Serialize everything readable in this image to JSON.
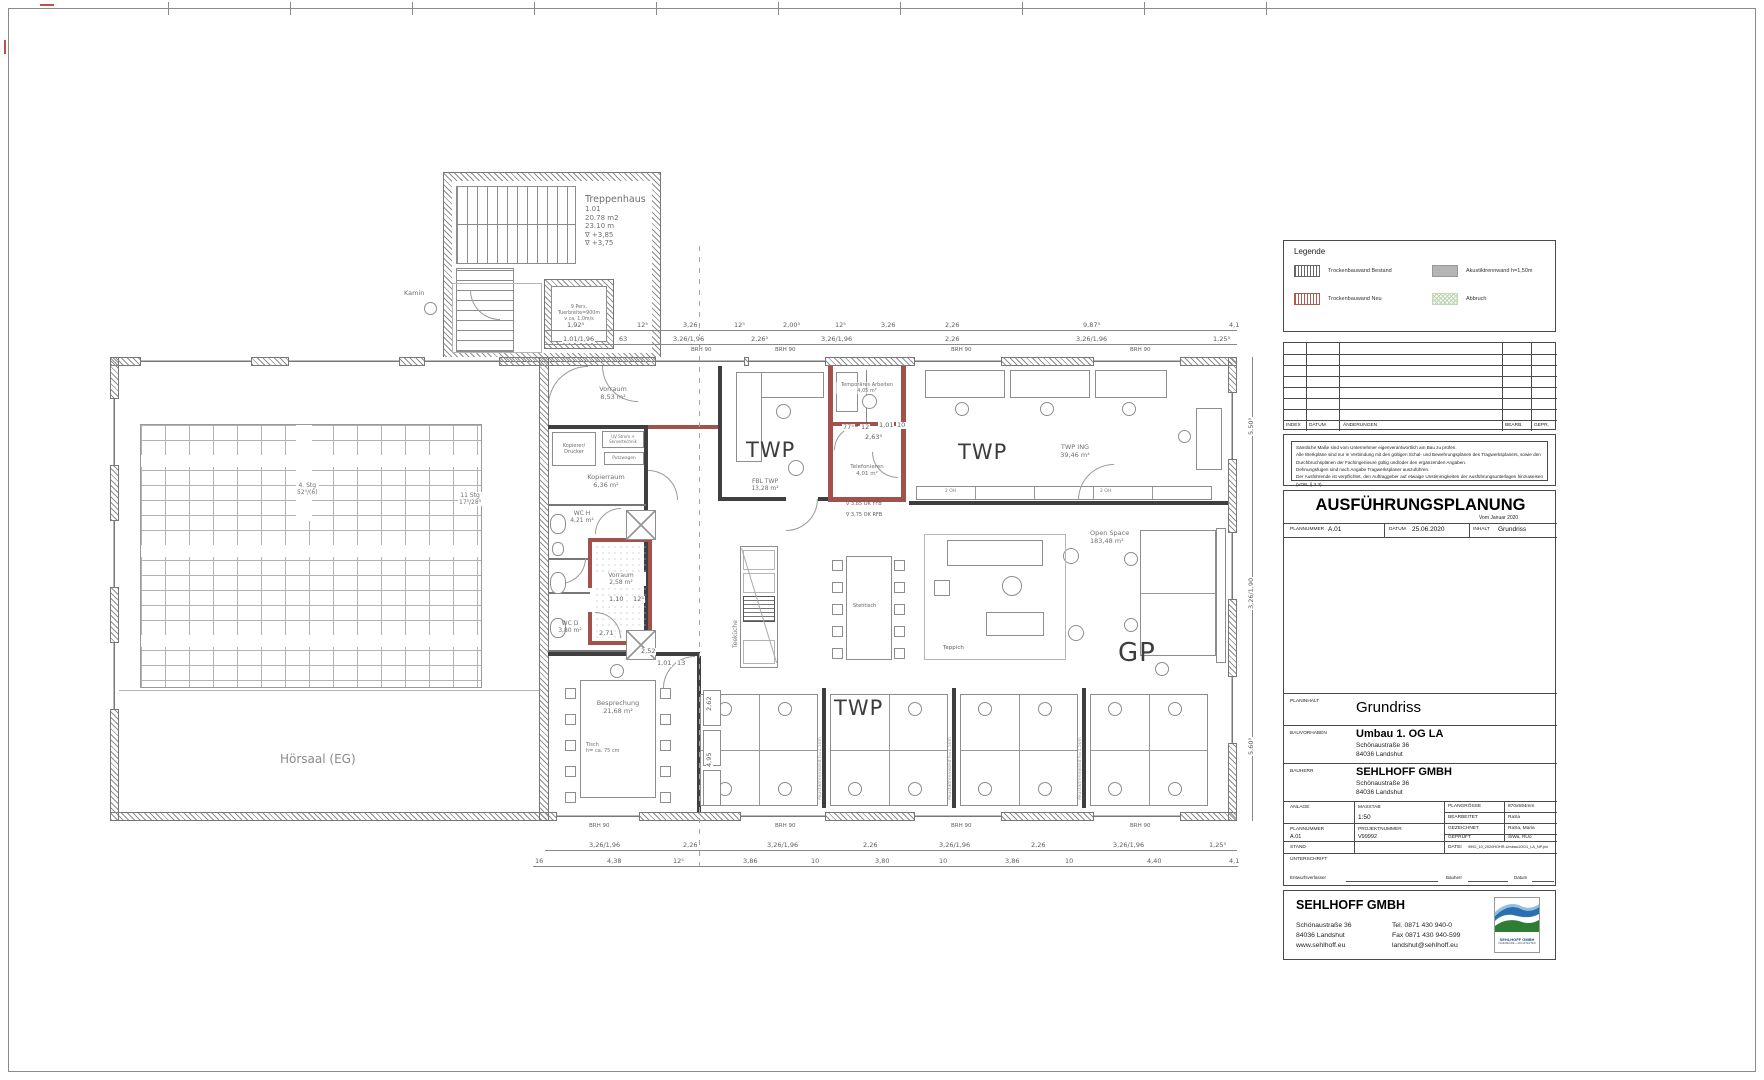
{
  "plan": {
    "treppenhaus": {
      "name": "Treppenhaus",
      "nr": "1.01",
      "area": "20.78 m2",
      "len": "23.10 m",
      "lv1": "∇  +3,85",
      "lv2": "∇  +3,75"
    },
    "aufzug": {
      "l1": "9 Pers.",
      "l2": "Tuerbreite=900m",
      "l3": "v ca. 1,0m/s"
    },
    "kamin": "Kamin",
    "hoersaal": "Hörsaal (EG)",
    "stair1": {
      "l1": "4. Stg",
      "l2": "52⁵/(6)"
    },
    "stair2": {
      "l1": "11 Stg",
      "l2": "17⁵/28⁵"
    },
    "brh": "BRH 90",
    "akustik": "Akustiktrennwand h=1,50m",
    "cabinet": "2 OH",
    "gp": "GP",
    "twp": "TWP"
  },
  "rooms": {
    "vorraum1": {
      "name": "Vorraum",
      "area": "8,53 m²"
    },
    "kopierer": {
      "l1": "Kopierer/",
      "l2": "Drucker"
    },
    "uv": {
      "l1": "UV Strom +",
      "l2": "Servertechnik"
    },
    "putzwagen": "Putzwagen",
    "kopierraum": {
      "name": "Kopierraum",
      "area": "6,36 m²"
    },
    "wch": {
      "name": "WC H",
      "area": "4,21 m²"
    },
    "vorraum2": {
      "name": "Vorraum",
      "area": "2,58 m²"
    },
    "wcd": {
      "name": "WC D",
      "area": "3,80 m²"
    },
    "besprechung": {
      "name": "Besprechung",
      "area": "21,68 m²",
      "note1": "Tisch",
      "note2": "h= ca. 75 cm"
    },
    "teekueche": "Teeküche",
    "stehtisch": "Stehtisch",
    "teppich": "Teppich",
    "fbl": {
      "name": "FBL TWP",
      "area": "13,28 m²"
    },
    "temp": {
      "name": "Temporäres Arbeiten",
      "area": "4,05 m²"
    },
    "telefonieren": {
      "name": "Telefonieren",
      "area": "4,01 m²"
    },
    "twping": {
      "name": "TWP ING",
      "area": "39,46 m²"
    },
    "openspace": {
      "name": "Open Space",
      "area": "183,48 m²"
    }
  },
  "dims": {
    "top1": [
      "1,92⁵",
      "12⁵",
      "3,26",
      "12⁵",
      "2,00⁵",
      "12⁵",
      "3,26",
      "2,26",
      "9,87⁵",
      "4,1"
    ],
    "top2": [
      "1,01/1,96",
      "63",
      "3,26/1,96",
      "2,26⁵",
      "3,26/1,96",
      "2,26",
      "3,26/1,96",
      "1,25⁵"
    ],
    "bottom1": [
      "3,26/1,96",
      "2,26",
      "3,26/1,96",
      "2,26",
      "3,26/1,96",
      "2,26",
      "3,26/1,96",
      "1,25⁵"
    ],
    "bottom2": [
      "16",
      "4,38",
      "12⁵",
      "3,86",
      "10",
      "3,80",
      "10",
      "3,86",
      "10",
      "4,40",
      "4,1"
    ],
    "right": [
      "5,50⁵",
      "3,26/1,90",
      "5,60⁵"
    ],
    "inner": [
      "2,52",
      "2,62",
      "4,95",
      "1,10",
      "12⁵",
      "2,71",
      "77⁵",
      "12",
      "1,01",
      "10",
      "2,63⁵",
      "1,01",
      "13"
    ],
    "levels": [
      "∇ 3,85 OK FFB",
      "∇ 3,75 OK RFB"
    ]
  },
  "legend": {
    "title": "Legende",
    "items": [
      {
        "type": "hatch-gray",
        "label": "Trockenbauwand Bestand"
      },
      {
        "type": "hatch-red",
        "label": "Trockenbauwand Neu"
      },
      {
        "type": "solid-gray",
        "label": "Akustiktrennwand h=1,50m"
      },
      {
        "type": "hatch-green",
        "label": "Abbruch"
      }
    ]
  },
  "index_table": {
    "headers": [
      "INDEX",
      "DATUM",
      "ÄNDERUNGEN",
      "BEARB.",
      "GEPR."
    ]
  },
  "notes": {
    "lines": [
      "Sämtliche Maße sind vom Unternehmer eigenverantwortlich am Bau zu prüfen.",
      "Alle Werkpläne sind nur in Verbindung mit den gültigen Schal- und Bewehrungsplänen des Tragwerksplaners, sowie den",
      "Durchbruchsplänen der Fachingenieure gültig und/oder den ergänzenden Angaben.",
      "Dehnungsfugen sind nach Angabe Tragwerksplaner auszuführen.",
      "Der Ausführende ist verpflichtet, den Auftraggeber auf etwaige Unstimmigkeiten der Ausführungsunterlagen hinzuweisen (VOB, § 3.3)."
    ]
  },
  "titleblock": {
    "title": "AUSFÜHRUNGSPLANUNG",
    "subtitle": "Vom Januar 2020",
    "plannummer_label": "PLANNUMMER",
    "plannummer": "A.01",
    "datum_label": "DATUM",
    "datum": "25.06.2020",
    "inhalt_label": "INHALT",
    "inhalt": "Grundriss",
    "planinhalt_label": "PLANINHALT",
    "planinhalt": "Grundriss",
    "bauvorhaben_label": "BAUVORHABEN",
    "bauvorhaben": "Umbau 1. OG LA",
    "bv_addr1": "Schönaustraße 36",
    "bv_addr2": "84036 Landshut",
    "bauherr_label": "BAUHERR",
    "bauherr": "SEHLHOFF GMBH",
    "bh_addr1": "Schönaustraße 36",
    "bh_addr2": "84036 Landshut",
    "anlage_label": "ANLAGE",
    "masstab_label": "MASSTAB",
    "masstab": "1:50",
    "plangroesse_label": "PLANGRÖSSE",
    "plangroesse": "870x594mm",
    "bearbeitet_label": "BEARBEITET",
    "bearbeitet": "RaSa",
    "projektnummer_label": "PROJEKTNUMMER",
    "projektnummer": "V99992",
    "gezeichnet_label": "GEZEICHNET",
    "gezeichnet": "RaSa, Maria",
    "geprueft_label": "GEPRÜFT",
    "geprueft": "SiWa, RUo",
    "stand_label": "STAND",
    "datei_label": "DATEI",
    "datei": "9992_10_2020HOHR-Umbau1OG1_LA_NP.pln",
    "unterschrift_label": "UNTERSCHRIFT",
    "sig1": "Entwurfsverfasser",
    "sig2": "Bauherr",
    "sig3": "Datum"
  },
  "company": {
    "name": "SEHLHOFF GMBH",
    "addr1": "Schönaustraße 36",
    "addr2": "84036 Landshut",
    "addr3": "www.sehlhoff.eu",
    "tel": "Tel. 0871 430 940-0",
    "fax": "Fax 0871 430 940-599",
    "mail": "landshut@sehlhoff.eu",
    "logo_name": "SEHLHOFF GMBH",
    "logo_sub": "INGENIEURE + ARCHITEKTEN",
    "logo_blue": "#2a6fb0",
    "logo_lightblue": "#8fc0e0",
    "logo_green": "#2e7d35"
  }
}
